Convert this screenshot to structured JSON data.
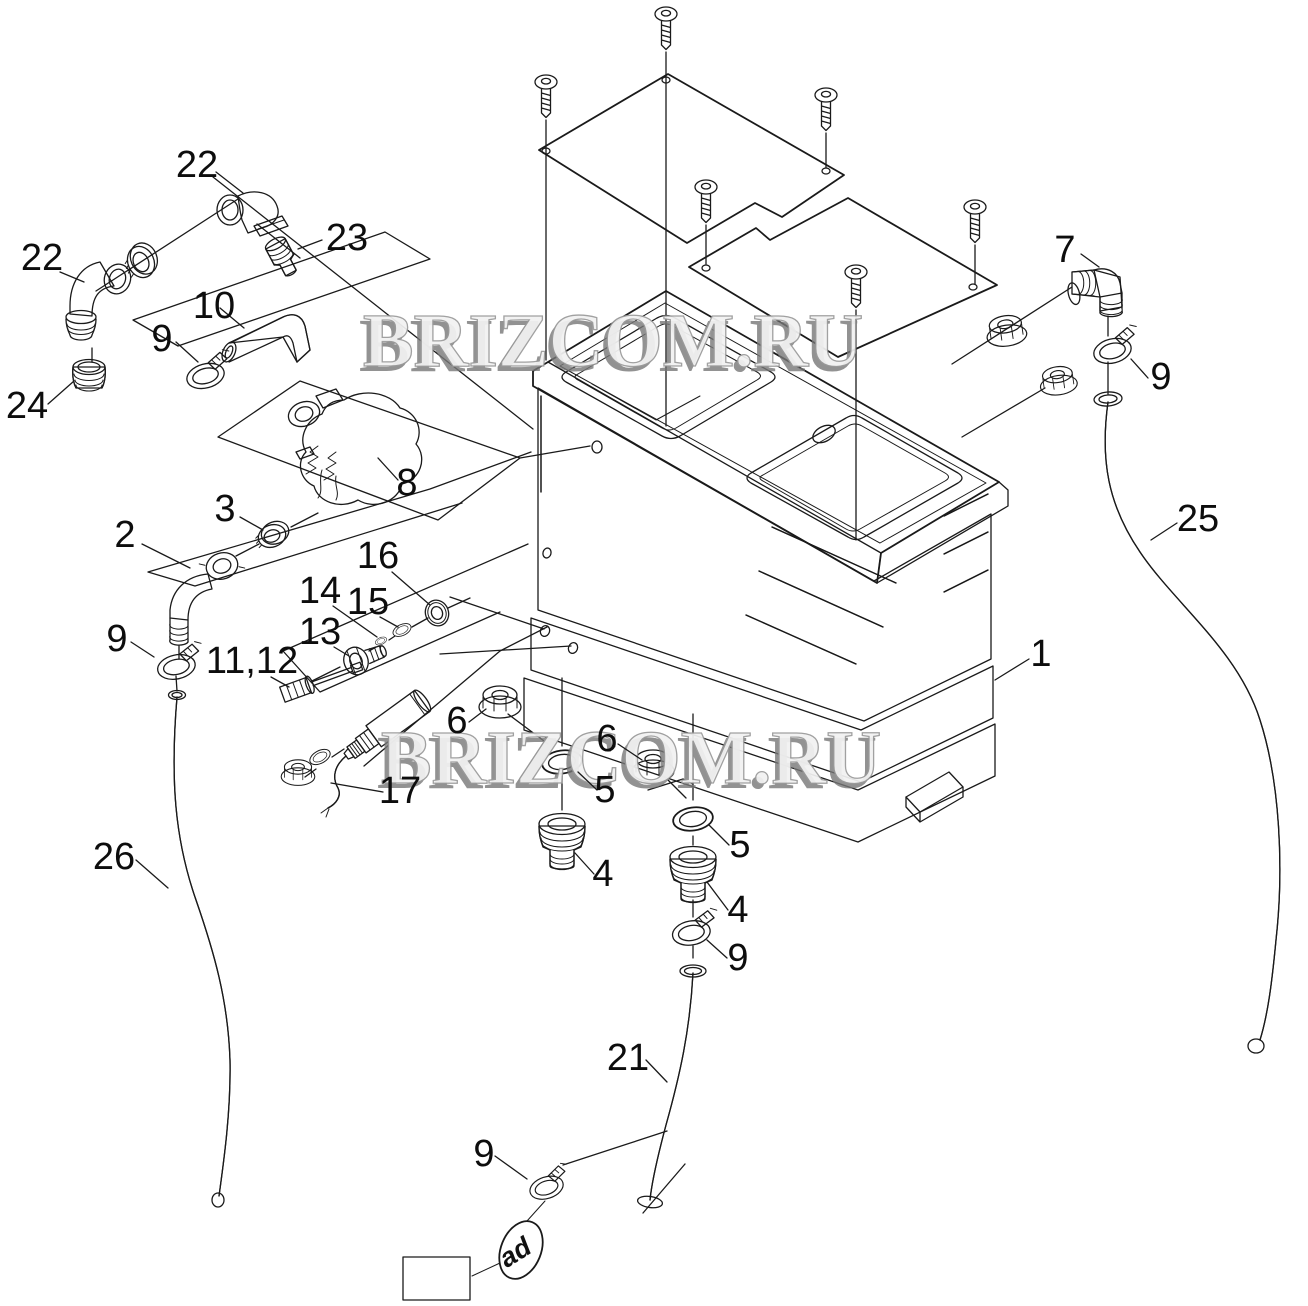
{
  "colors": {
    "line": "#1a1a1a",
    "badge_blue": "#1478d6",
    "badge_text": "#ffffff",
    "watermark_gray": "#8f8f8f"
  },
  "watermark": {
    "text": "BRIZCOM.RU"
  },
  "badge": {
    "label": "3.2"
  },
  "variant_tag": {
    "label": "ad"
  },
  "callouts": [
    {
      "id": "callout-22-top",
      "label": "22"
    },
    {
      "id": "callout-23",
      "label": "23"
    },
    {
      "id": "callout-22-left",
      "label": "22"
    },
    {
      "id": "callout-24",
      "label": "24"
    },
    {
      "id": "callout-10",
      "label": "10"
    },
    {
      "id": "callout-9-hose10-clamp",
      "label": "9"
    },
    {
      "id": "callout-8",
      "label": "8"
    },
    {
      "id": "callout-2",
      "label": "2"
    },
    {
      "id": "callout-3",
      "label": "3"
    },
    {
      "id": "callout-9-elbow2-clamp",
      "label": "9"
    },
    {
      "id": "callout-26",
      "label": "26"
    },
    {
      "id": "callout-16",
      "label": "16"
    },
    {
      "id": "callout-14",
      "label": "14"
    },
    {
      "id": "callout-15",
      "label": "15"
    },
    {
      "id": "callout-13",
      "label": "13"
    },
    {
      "id": "callout-11-12",
      "label": "11,12"
    },
    {
      "id": "callout-17",
      "label": "17"
    },
    {
      "id": "callout-6-left",
      "label": "6"
    },
    {
      "id": "callout-6-right",
      "label": "6"
    },
    {
      "id": "callout-5-left",
      "label": "5"
    },
    {
      "id": "callout-5-right",
      "label": "5"
    },
    {
      "id": "callout-4-left",
      "label": "4"
    },
    {
      "id": "callout-4-right",
      "label": "4"
    },
    {
      "id": "callout-9-hose21-clamp",
      "label": "9"
    },
    {
      "id": "callout-21",
      "label": "21"
    },
    {
      "id": "callout-9-bottom-clamp",
      "label": "9"
    },
    {
      "id": "callout-1",
      "label": "1"
    },
    {
      "id": "callout-7",
      "label": "7"
    },
    {
      "id": "callout-9-hose25-clamp",
      "label": "9"
    },
    {
      "id": "callout-25",
      "label": "25"
    }
  ]
}
